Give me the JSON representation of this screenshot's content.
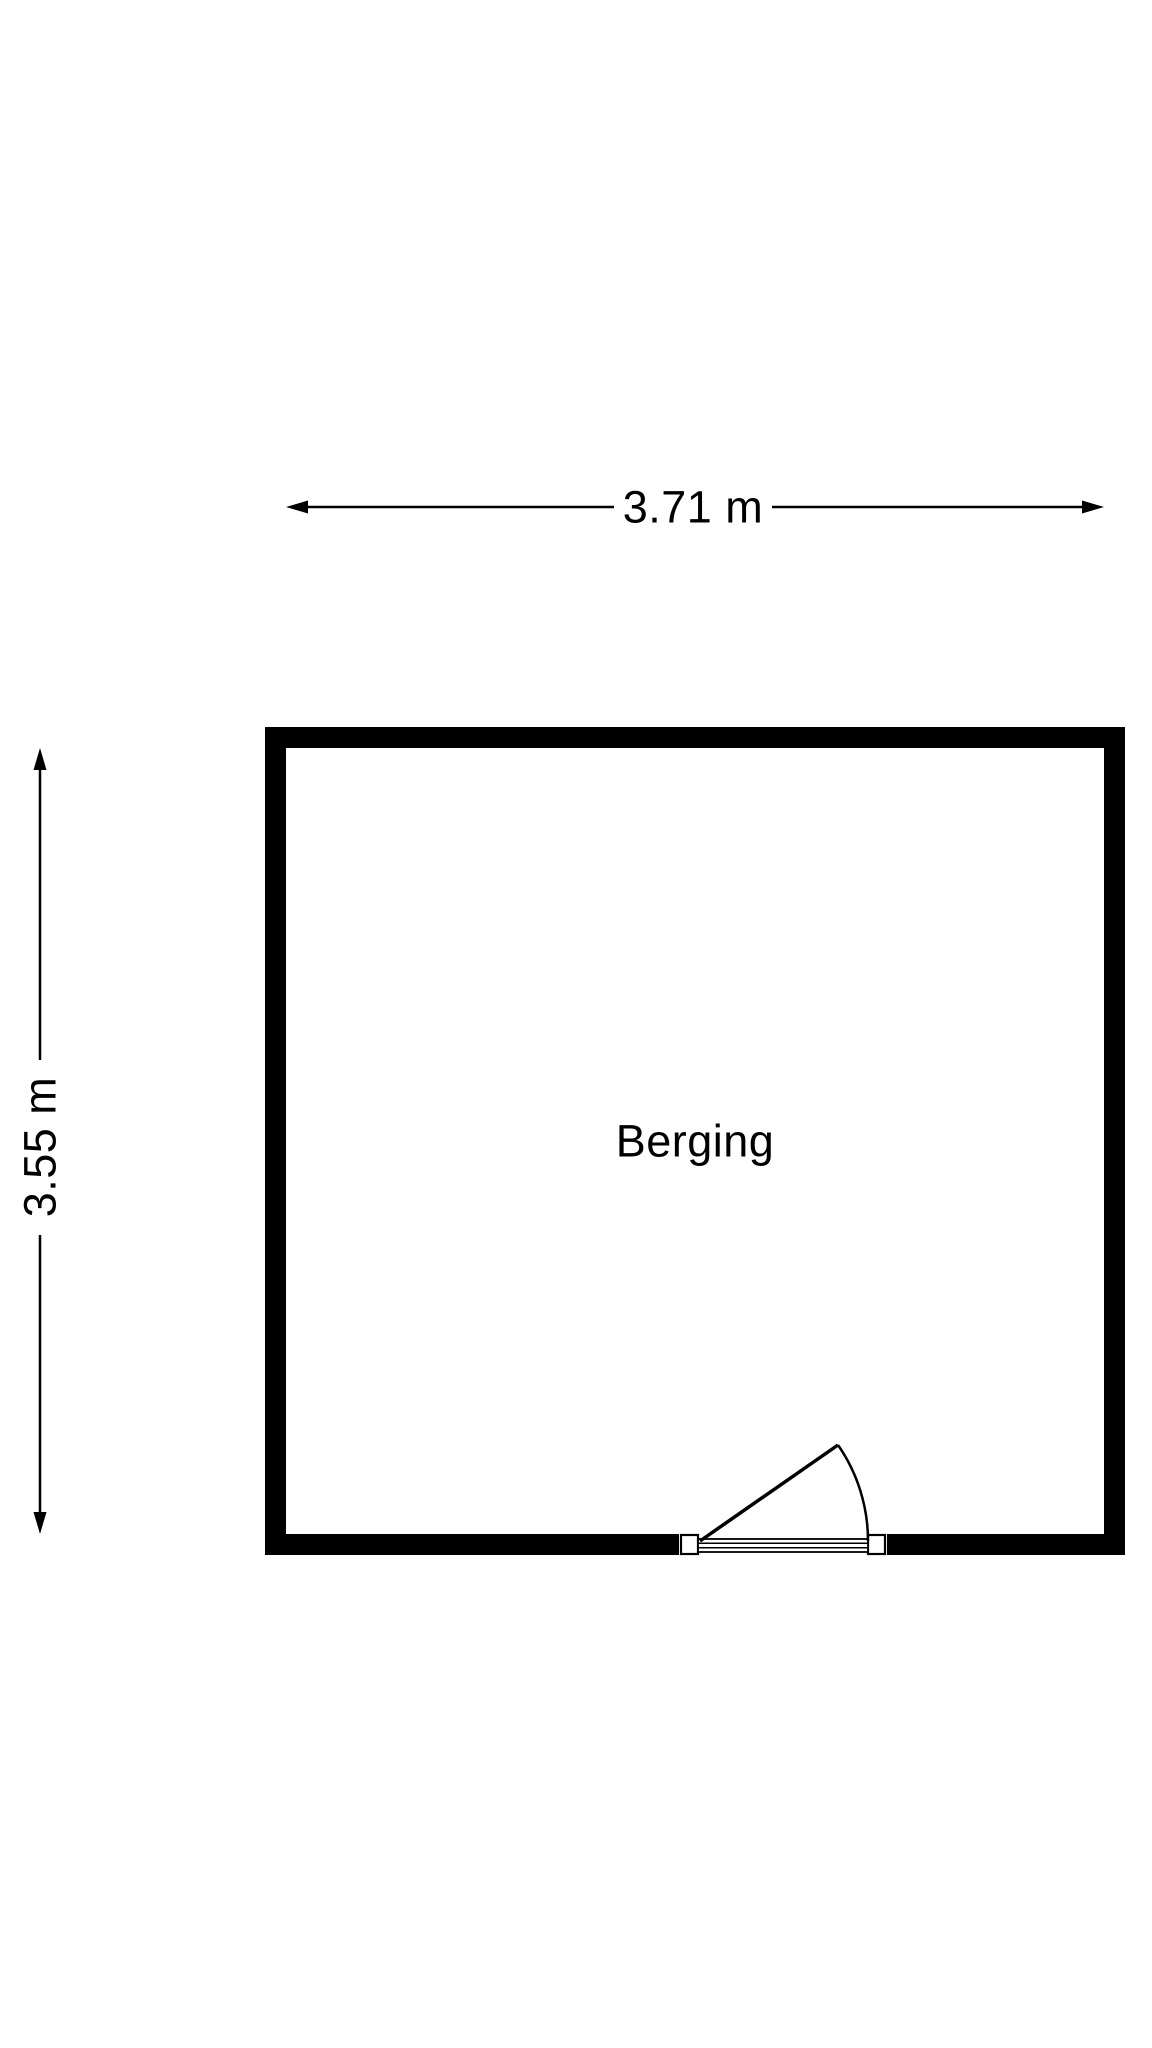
{
  "colors": {
    "background": "#ffffff",
    "line": "#000000",
    "wall_fill": "#000000"
  },
  "floorplan": {
    "room": {
      "label": "Berging"
    },
    "dimensions": {
      "width_label": "3.71 m",
      "height_label": "3.55 m"
    },
    "icons": {
      "dim_arrow_left": "dim-arrow-left-icon",
      "dim_arrow_right": "dim-arrow-right-icon",
      "dim_arrow_up": "dim-arrow-up-icon",
      "dim_arrow_down": "dim-arrow-down-icon",
      "door_swing": "door-swing-arc-icon"
    }
  }
}
